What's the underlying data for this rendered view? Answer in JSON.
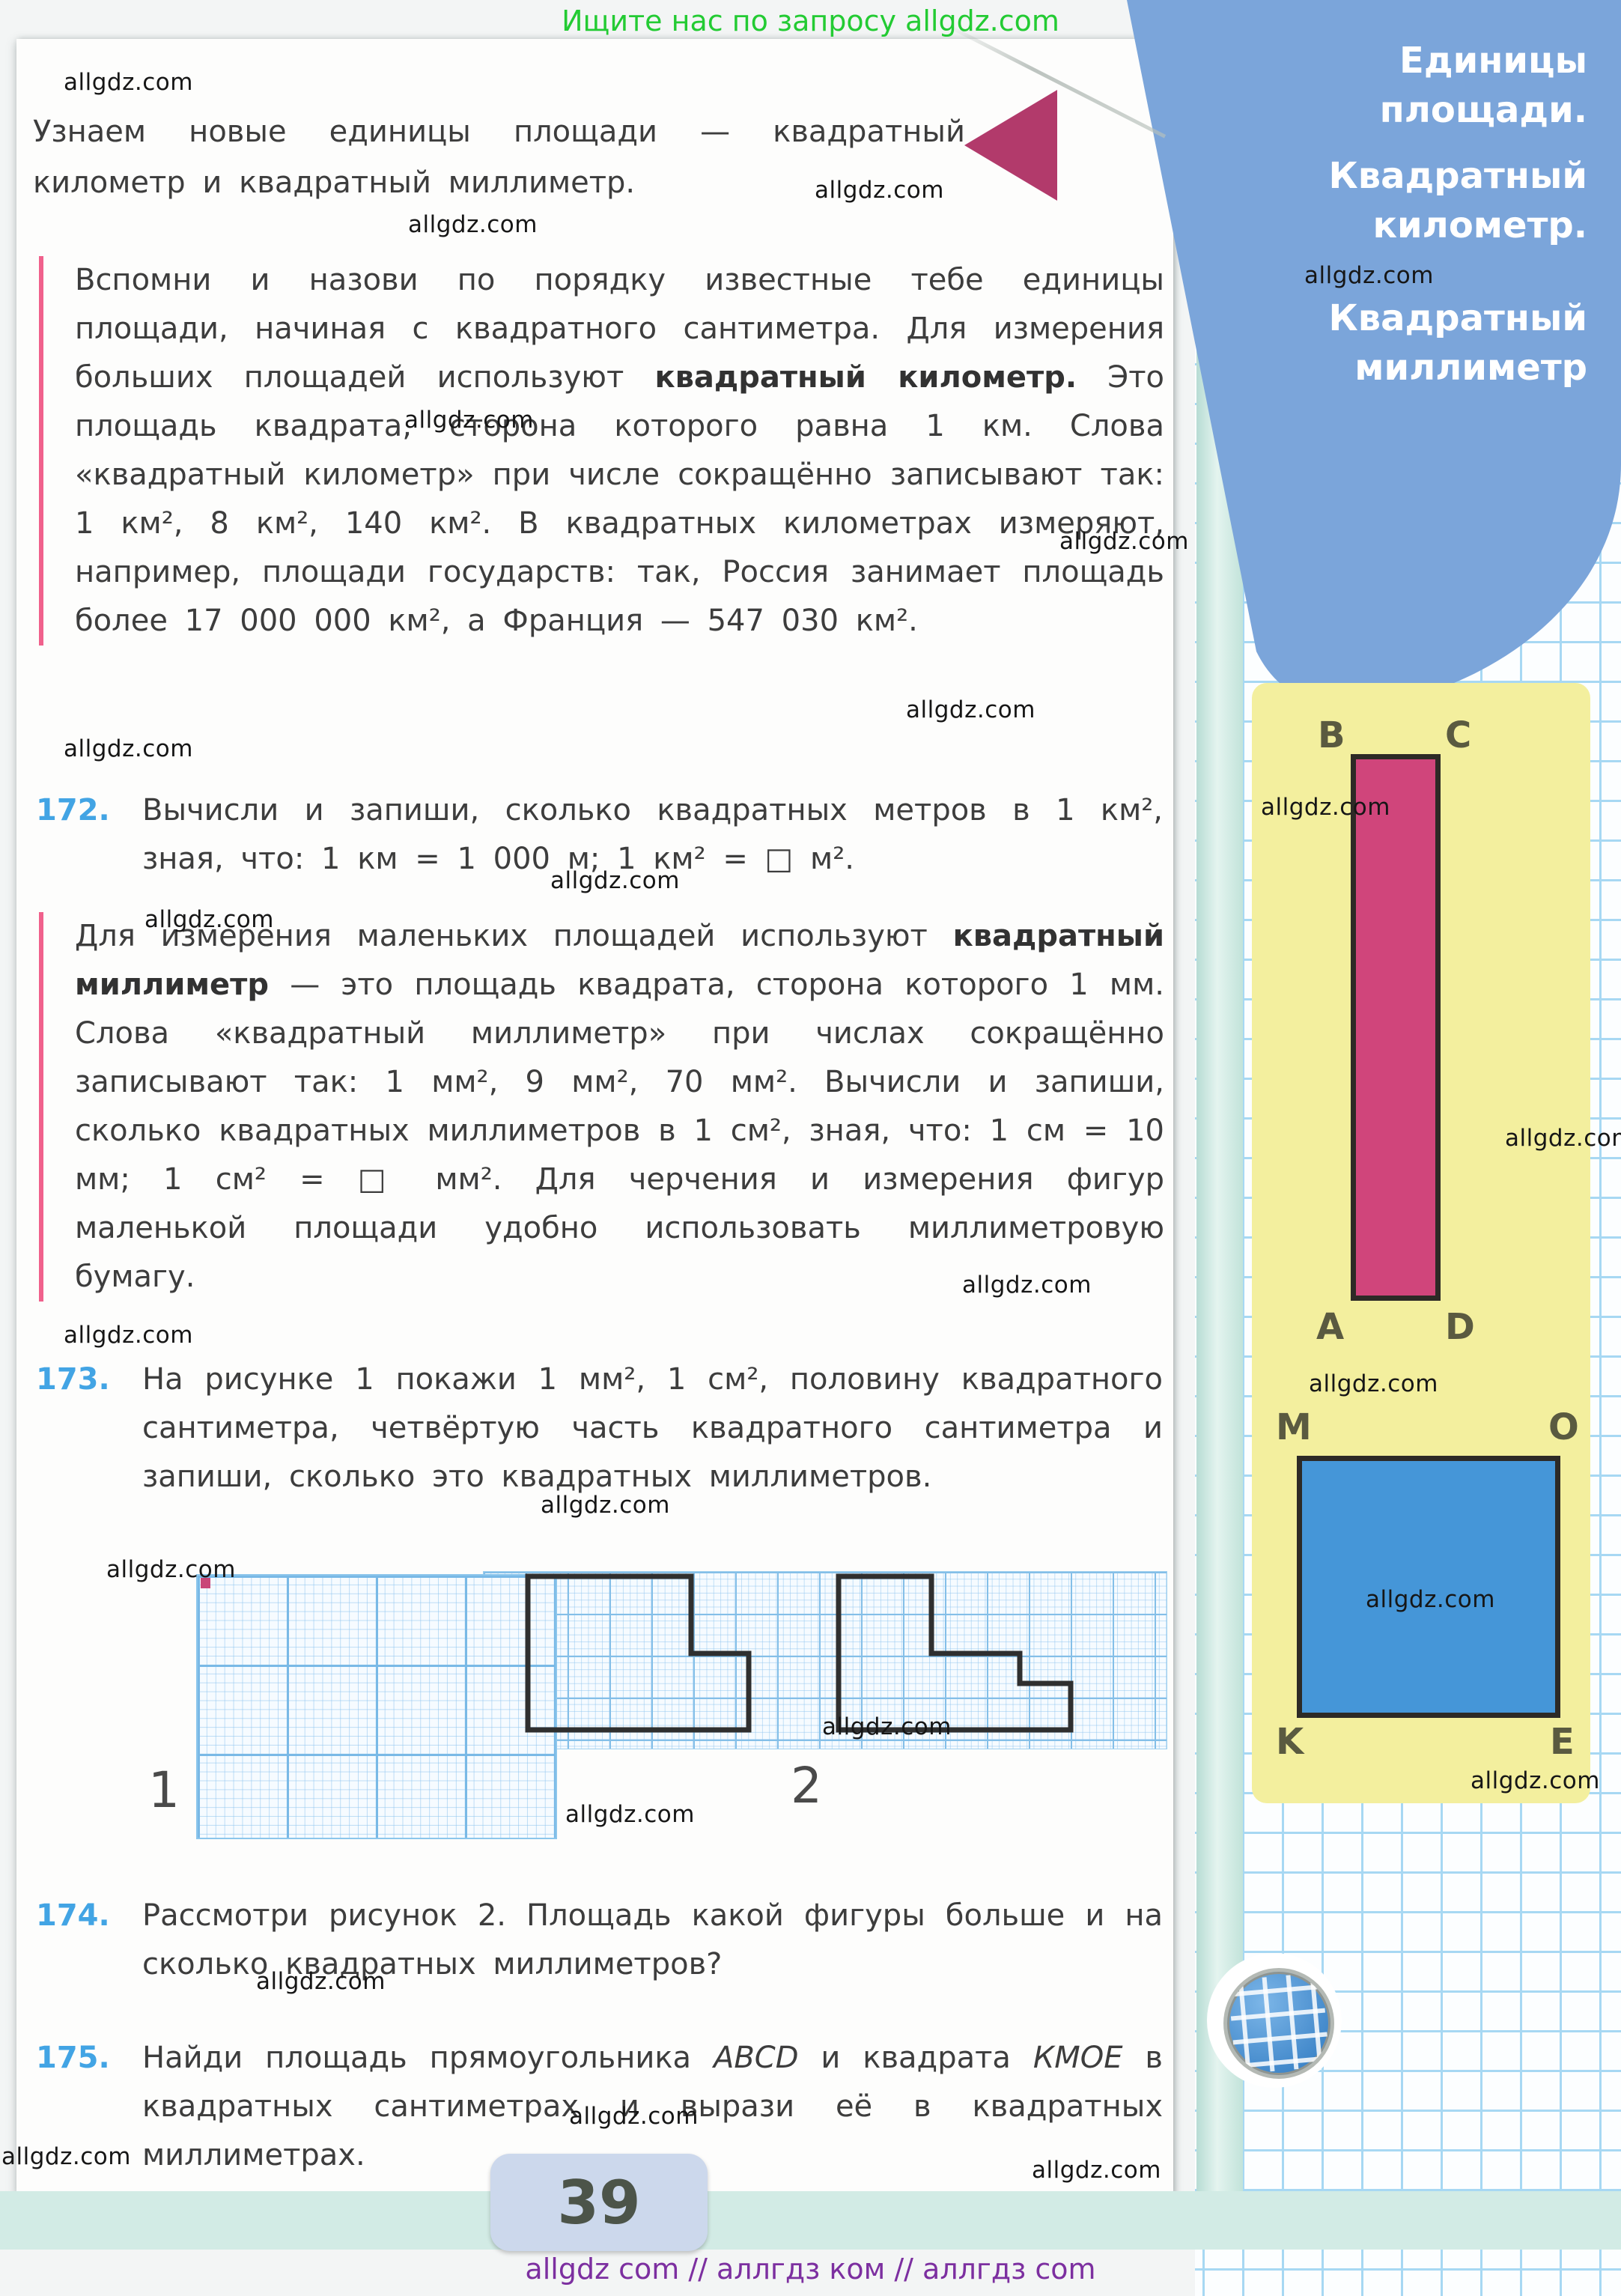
{
  "promo_top": "Ищите нас по запросу allgdz.com",
  "watermark": "allgdz.com",
  "page_number": "39",
  "footer": "allgdz com  //  аллгдз ком  //  аллгдз com",
  "sidebar": {
    "lines": [
      "Единицы",
      "площади.",
      "Квадратный",
      "километр.",
      "Квадратный",
      "миллиметр"
    ]
  },
  "intro": "Узнаем новые единицы площади — квадратный километр и квадратный миллиметр.",
  "block1": {
    "part1": "Вспомни и назови по порядку известные тебе единицы площади, начиная с квадратного сантиметра. Для измерения больших площадей используют ",
    "bold": "квадратный километр.",
    "part2": " Это площадь квадрата, сторона которого равна 1 км. Слова «квадратный километр» при числе сокращённо записывают так: 1 км², 8 км², 140 км². В квадратных километрах измеряют, например, площади государств: так, Россия занимает площадь более 17 000 000 км², а Франция — 547 030 км²."
  },
  "block2": {
    "part1": "Для измерения маленьких площадей используют ",
    "bold": "квадратный миллиметр",
    "part2": " — это площадь квадрата, сторона которого 1 мм. Слова «квадратный миллиметр» при числах сокращённо записывают так: 1 мм², 9 мм², 70 мм². Вычисли и запиши, сколько квадратных миллиметров в 1 см², зная, что: 1 см = 10 мм; 1 см² = □ мм². Для черчения и измерения фигур маленькой площади удобно использовать миллиметровую бумагу."
  },
  "tasks": {
    "t172": {
      "num": "172.",
      "text": "Вычисли и запиши, сколько квадратных метров в 1 км², зная, что: 1 км = 1 000 м; 1 км² = □ м²."
    },
    "t173": {
      "num": "173.",
      "text": "На рисунке 1 покажи 1 мм², 1 см², половину квадратного сантиметра, четвёртую часть квадратного сантиметра и запиши, сколько это квадратных миллиметров."
    },
    "t174": {
      "num": "174.",
      "text": "Рассмотри рисунок 2. Площадь какой фигуры больше и на сколько квадратных миллиметров?"
    },
    "t175": {
      "num": "175.",
      "part1": "Найди площадь прямоугольника ",
      "name1": "ABCD",
      "part2": " и квадрата ",
      "name2": "КМОЕ",
      "part3": " в квадратных сантиметрах и вырази её в квадратных миллиметрах."
    }
  },
  "figures": {
    "fig1_label": "1",
    "fig2_label": "2"
  },
  "geometry": {
    "rect_labels": {
      "tl": "B",
      "tr": "C",
      "bl": "A",
      "br": "D"
    },
    "square_labels": {
      "tl": "M",
      "tr": "O",
      "bl": "K",
      "br": "E"
    }
  },
  "colors": {
    "accent_pink_bar": "#f0618c",
    "arrow_pink": "#b23a6b",
    "rect_fill": "#d0457b",
    "square_fill": "#4596d8",
    "panel_yellow": "#f3ef9e",
    "cover_blue": "#7ba5da",
    "task_number_blue": "#42a4e4",
    "promo_green": "#23cb33",
    "footer_purple": "#7c2fa0",
    "mm_square_pink": "#c94678"
  }
}
